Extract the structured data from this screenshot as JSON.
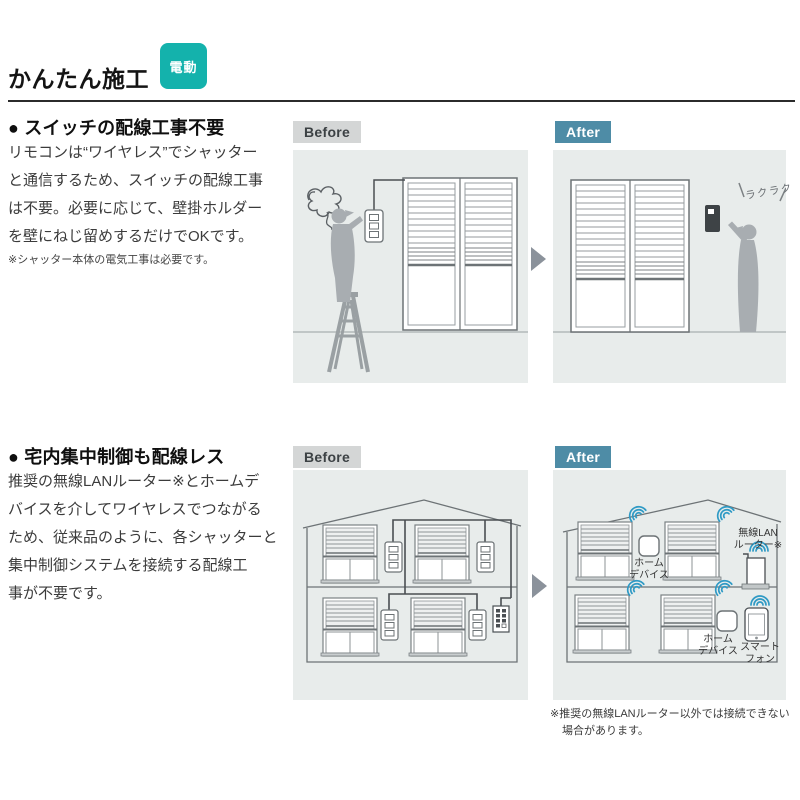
{
  "page": {
    "title": "かんたん施工",
    "badge": "電動"
  },
  "colors": {
    "accent_teal": "#14b2ac",
    "after_blue": "#4e8ca6",
    "before_gray": "#d4d6d6",
    "panel_background": "#e8eceb",
    "wifi_blue": "#2f9ac5",
    "silhouette_gray": "#a8adb1"
  },
  "section1": {
    "heading": "● スイッチの配線工事不要",
    "body": "リモコンは“ワイヤレス”でシャッター\nと通信するため、スイッチの配線工事\nは不要。必要に応じて、壁掛ホルダー\nを壁にねじ留めするだけでOKです。",
    "note": "※シャッター本体の電気工事は必要です。",
    "before_label": "Before",
    "after_label": "After",
    "after_annotation": "ラクラク"
  },
  "section2": {
    "heading": "● 宅内集中制御も配線レス",
    "body": "推奨の無線LANルーター※とホームデ\nバイスを介してワイヤレスでつながる\nため、従来品のように、各シャッターと\n集中制御システムを接続する配線工\n事が不要です。",
    "before_label": "Before",
    "after_label": "After",
    "home_device_2f_label": "ホーム\nデバイス",
    "router_label": "無線LAN\nルーター※",
    "home_device_1f_label": "ホーム\nデバイス",
    "smartphone_label": "スマート\nフォン",
    "footnote": "※推奨の無線LANルーター以外では接続できない\n場合があります。"
  }
}
